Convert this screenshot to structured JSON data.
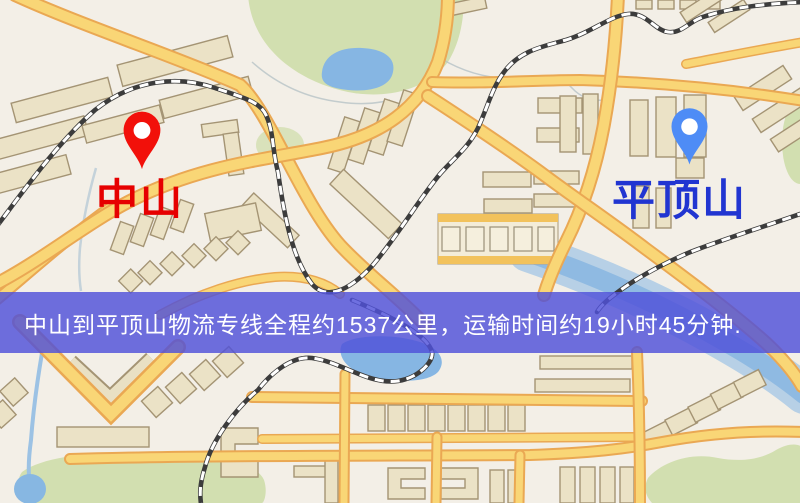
{
  "map": {
    "markers": [
      {
        "name": "origin",
        "label": "中山",
        "pin_color": "#f2100a",
        "label_color": "#e60000",
        "icon": "map-pin-icon"
      },
      {
        "name": "destination",
        "label": "平顶山",
        "pin_color": "#4e8cf6",
        "label_color": "#2135d1",
        "icon": "map-pin-icon"
      }
    ],
    "banner": {
      "text": "中山到平顶山物流专线全程约1537公里，运输时间约19小时45分钟.",
      "bg_color": "rgba(79,80,217,0.82)",
      "text_color": "#ffffff"
    },
    "palette": {
      "background": "#f3efe7",
      "road_fill": "#f9d676",
      "road_casing": "#eaa853",
      "water": "#87b7e2",
      "park": "#d2dfb0",
      "building_fill": "#ebe2c6",
      "building_outline": "#a49474",
      "railway": "#3c3c3c"
    }
  }
}
